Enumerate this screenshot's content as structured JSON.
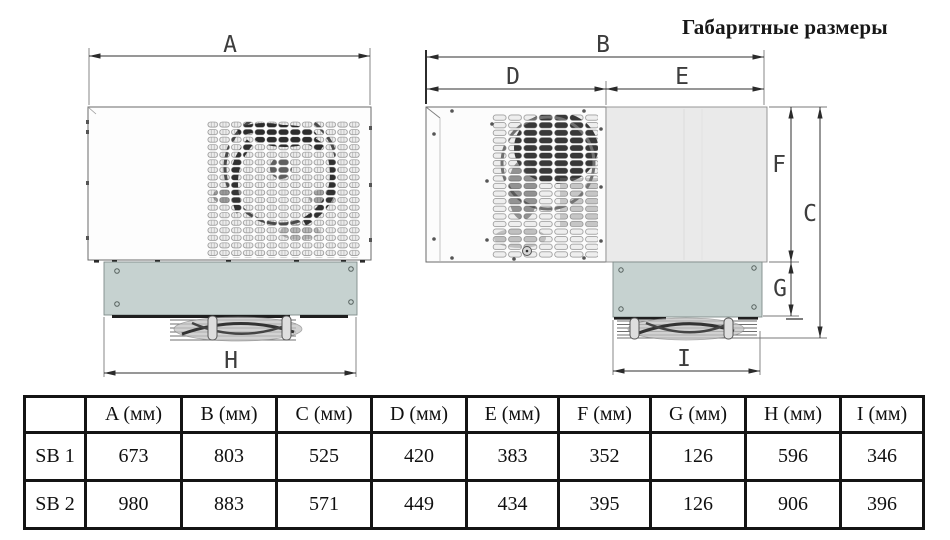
{
  "title": "Габаритные размеры",
  "drawing": {
    "dim_labels": {
      "A": "A",
      "B": "B",
      "C": "C",
      "D": "D",
      "E": "E",
      "F": "F",
      "G": "G",
      "H": "H",
      "I": "I"
    },
    "views": [
      "top-view-monoblock",
      "side-view-monoblock"
    ]
  },
  "table": {
    "headers": [
      "",
      "A (мм)",
      "B (мм)",
      "C (мм)",
      "D (мм)",
      "E (мм)",
      "F (мм)",
      "G (мм)",
      "H (мм)",
      "I (мм)"
    ],
    "rows": [
      {
        "label": "SB 1",
        "values": [
          "673",
          "803",
          "525",
          "420",
          "383",
          "352",
          "126",
          "596",
          "346"
        ]
      },
      {
        "label": "SB 2",
        "values": [
          "980",
          "883",
          "571",
          "449",
          "434",
          "395",
          "126",
          "906",
          "396"
        ]
      }
    ]
  },
  "colors": {
    "panel_green": "#c6d2d0",
    "panel_gray": "#eaeaea",
    "line": "#3a3a3a",
    "fan_dark": "#2c2c2c"
  }
}
